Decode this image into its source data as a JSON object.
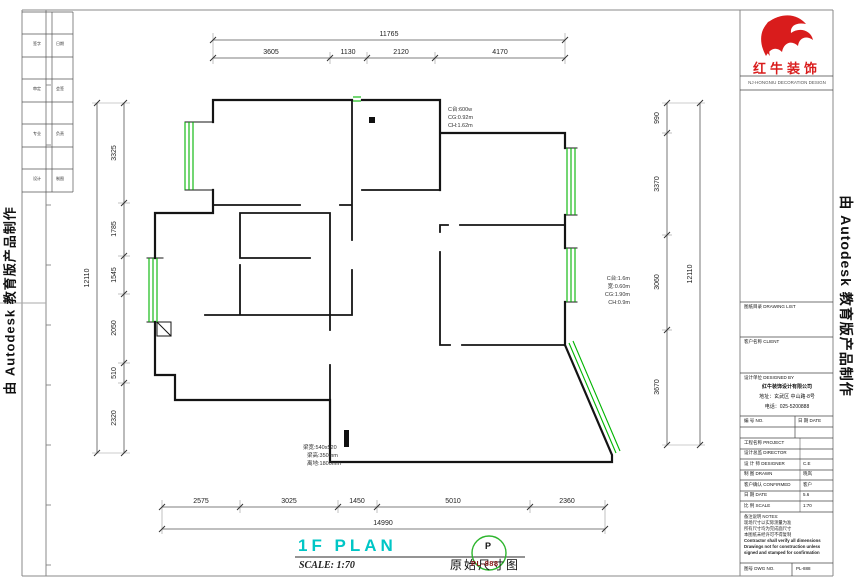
{
  "edge": {
    "autodesk_left": "由 Autodesk 教育版产品制作",
    "autodesk_right": "由 Autodesk 教育版产品制作"
  },
  "brand": {
    "name": "红牛装饰",
    "subtitle": "NJ·HONGNIU DECORATION DESIGN"
  },
  "revision": {
    "rows": [
      {
        "a": "签字",
        "b": "日期"
      },
      {
        "a": "审定",
        "b": "会签"
      },
      {
        "a": "专业",
        "b": "负责"
      },
      {
        "a": "设计",
        "b": "制图"
      }
    ]
  },
  "title_block": {
    "sections": [
      {
        "label": "图纸目录 DRAWING LIST"
      },
      {
        "label": "客户名称 CLIENT"
      },
      {
        "label": "设计单位 DESIGNED BY"
      }
    ],
    "company": {
      "name": "红牛装饰设计有限公司",
      "address": "地址：玄武区 中山路·8号",
      "phone": "电话：025-5200888"
    },
    "mini": {
      "left": "编 号 NO.",
      "right": "日 期 DATE"
    },
    "rows": [
      {
        "label": "工程名称 PROJECT",
        "value": ""
      },
      {
        "label": "设计总监 DIRECTOR",
        "value": ""
      },
      {
        "label": "设 计 师 DESIGNER",
        "value": "C.E"
      },
      {
        "label": "制 图 DRAWN",
        "value": "晓岚"
      },
      {
        "label": "客户确认 CONFIRMED",
        "value": "客户"
      },
      {
        "label": "日 期 DATE",
        "value": "5.6"
      },
      {
        "label": "比 例 SCALE",
        "value": "1:70"
      }
    ],
    "notes": {
      "title": "备注说明 NOTES:",
      "lines": [
        "现场尺寸以实际测量为准",
        "所有尺寸均为完成面尺寸",
        "本图纸未经许可不得复制",
        "Contractor shall verify all dimensions",
        "Drawings not for construction unless",
        "signed and stamped for confirmation"
      ]
    },
    "footer_left": "图号 DWG NO.",
    "footer_right": "PL-888"
  },
  "dims": {
    "top_total": "11765",
    "top": [
      "3605",
      "1130",
      "2120",
      "4170"
    ],
    "bottom": [
      "2575",
      "3025",
      "1450",
      "5010",
      "2360"
    ],
    "bottom_total": "14990",
    "left": [
      "3325",
      "1785",
      "1545",
      "2050",
      "510",
      "2320"
    ],
    "left_total": "12110",
    "right": [
      "990",
      "3370",
      "3060",
      "3670"
    ],
    "right_total": "12110"
  },
  "annotations": {
    "window_top": [
      "C台:600w",
      "CG:0.92m",
      "CH:1.62m"
    ],
    "window_right": [
      "C台:1.6m",
      "宽:0.60m",
      "CG:1.90m",
      "CH:0.9m"
    ],
    "beam": [
      "梁宽:540x520",
      "梁高:350mm",
      "离地:1800mm"
    ]
  },
  "footer": {
    "plan_title": "1F PLAN",
    "scale": "SCALE: 1:70",
    "drawing_name": "原始尺寸图",
    "stamp_letter": "P",
    "stamp_code": "PL-888"
  },
  "colors": {
    "accent_red": "#d91c1c",
    "window_green": "#00b400",
    "plan_cyan": "#00c6c6",
    "stamp_green": "#2db52d",
    "stamp_red": "#8b1a1a"
  }
}
